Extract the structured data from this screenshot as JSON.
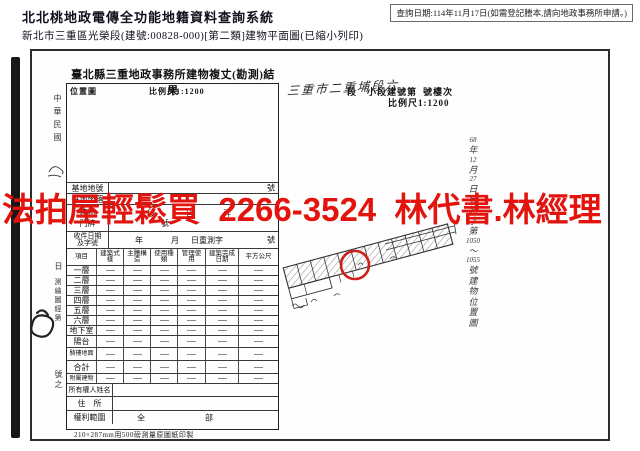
{
  "header": {
    "system_title": "北北桃地政電傳全功能地籍資料查詢系統",
    "query_date_note": "查詢日期:114年11月17日(如需登記謄本,請向地政事務所申請。)",
    "subtitle": "新北市三重區光榮段(建號:00828-000)[第二類]建物平面圖(已縮小列印)"
  },
  "overlay_ad": {
    "text": "法拍屋輕鬆買  2266-3524  林代書.林經理",
    "color": "#e3140d"
  },
  "scan": {
    "margin_vertical": [
      "中華民國",
      "日",
      "測繪圖經第",
      "號之"
    ],
    "form": {
      "title": "臺北縣三重地政事務所建物複丈(勘測)結果",
      "location_map_label": "位置圖",
      "scale_label": "比例尺1:1200",
      "site_no_label": "基地地號",
      "site_no_suffix": "號",
      "site_label": "基地坐落",
      "address_label": "建物門牌",
      "address_line1": "段 巷 弄",
      "address_line2": "號",
      "receipt_label_1": "收件日期",
      "receipt_label_2": "及字號",
      "receipt_year": "年",
      "receipt_month": "月",
      "receipt_word": "日重測字",
      "receipt_no": "號",
      "table_header": [
        "項目",
        "建築式樣",
        "主體構造",
        "使用種類",
        "管理使用",
        "建築完成日期",
        "平方公尺"
      ],
      "rows": [
        "一層",
        "二層",
        "三層",
        "四層",
        "五層",
        "六層",
        "地下室",
        "陽台",
        "騎樓地面",
        "合計",
        "附屬建物"
      ],
      "owner_name_label": "所有權人姓名",
      "residence_label": "住　所",
      "rights_label": "權利範圍",
      "rights_value": "全　部",
      "footnote": "210×287mm用500磅測量原圖紙印製"
    },
    "plan": {
      "handwritten_header": "三重市二重埔段六",
      "printed_header_a": "段　小段建號第",
      "printed_header_b": "號樓次",
      "scale_label": "比例尺1:1200",
      "vertical_note": [
        "68",
        "年",
        "12",
        "月",
        "27",
        "日",
        "會",
        "測",
        "字",
        "第",
        "1050",
        "〜",
        "1055",
        "號",
        "建",
        "物",
        "位",
        "置",
        "圖"
      ]
    }
  }
}
